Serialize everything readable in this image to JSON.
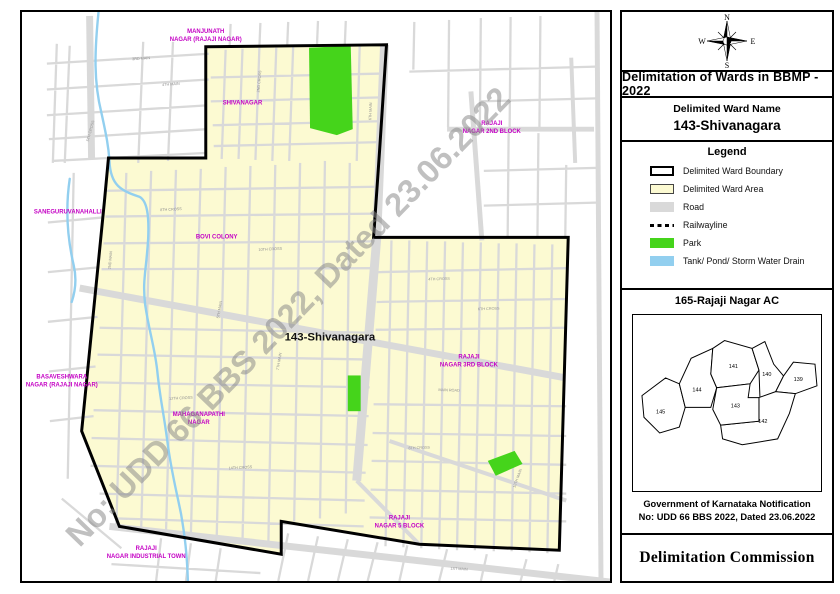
{
  "panel": {
    "compass": {
      "n": "N",
      "e": "E",
      "s": "S",
      "w": "W"
    },
    "title": "Delimitation of Wards in BBMP - 2022",
    "ward_name_heading": "Delimited Ward Name",
    "ward_name": "143-Shivanagara",
    "legend": {
      "heading": "Legend",
      "items": [
        {
          "label": "Delimited Ward Boundary",
          "swatch": "boundary"
        },
        {
          "label": "Delimited Ward Area",
          "swatch": "area",
          "color": "#fcfad2"
        },
        {
          "label": "Road",
          "swatch": "road",
          "color": "#d9d9d9"
        },
        {
          "label": "Railwayline",
          "swatch": "railway"
        },
        {
          "label": "Park",
          "swatch": "park",
          "color": "#45d41b"
        },
        {
          "label": "Tank/ Pond/ Storm Water Drain",
          "swatch": "tank",
          "color": "#92cfef"
        }
      ]
    },
    "ac_title": "165-Rajaji Nagar AC",
    "inset_wards": [
      {
        "id": "145",
        "x": 27,
        "y": 100,
        "highlight": false
      },
      {
        "id": "144",
        "x": 64,
        "y": 78,
        "highlight": false
      },
      {
        "id": "141",
        "x": 101,
        "y": 54,
        "highlight": false
      },
      {
        "id": "140",
        "x": 135,
        "y": 62,
        "highlight": false
      },
      {
        "id": "139",
        "x": 167,
        "y": 67,
        "highlight": false
      },
      {
        "id": "143",
        "x": 103,
        "y": 94,
        "highlight": true
      },
      {
        "id": "142",
        "x": 131,
        "y": 110,
        "highlight": false
      }
    ],
    "notification_line1": "Government of Karnataka Notification",
    "notification_line2": "No: UDD 66 BBS 2022, Dated 23.06.2022",
    "commission": "Delimitation Commission"
  },
  "map": {
    "watermark": "No: UDD 66 BBS 2022, Dated 23.06.2022",
    "colors": {
      "ward_area": "#fcfad2",
      "inset_highlight": "#f7f3bd",
      "road": "#d9d9d9",
      "park": "#45d41b",
      "water": "#92cfef",
      "boundary": "#000000",
      "area_label": "#c400c4",
      "watermark": "#888888"
    },
    "area_labels": [
      {
        "text": "MANJUNATH",
        "x": 185,
        "y": 21
      },
      {
        "text": "NAGAR (RAJAJI NAGAR)",
        "x": 185,
        "y": 29
      },
      {
        "text": "SHIVANAGAR",
        "x": 222,
        "y": 93
      },
      {
        "text": "RAJAJI",
        "x": 473,
        "y": 114
      },
      {
        "text": "NAGAR 2ND BLOCK",
        "x": 473,
        "y": 122
      },
      {
        "text": "SANEGURUVANAHALLI",
        "x": 46,
        "y": 203
      },
      {
        "text": "BOVI COLONY",
        "x": 196,
        "y": 228
      },
      {
        "text": "143-Shivanagara",
        "x": 310,
        "y": 331,
        "color": "#111111",
        "size": 11.5
      },
      {
        "text": "RAJAJI",
        "x": 450,
        "y": 349
      },
      {
        "text": "NAGAR 3RD BLOCK",
        "x": 450,
        "y": 357
      },
      {
        "text": "BASAVESHWARA",
        "x": 40,
        "y": 369
      },
      {
        "text": "NAGAR (RAJAJI NAGAR)",
        "x": 40,
        "y": 377
      },
      {
        "text": "MAHAGANAPATHI",
        "x": 178,
        "y": 407
      },
      {
        "text": "NAGAR",
        "x": 178,
        "y": 415
      },
      {
        "text": "RAJAJI",
        "x": 380,
        "y": 511
      },
      {
        "text": "NAGAR 5 BLOCK",
        "x": 380,
        "y": 519
      },
      {
        "text": "RAJAJI",
        "x": 125,
        "y": 542
      },
      {
        "text": "NAGAR INDUSTRIAL TOWN",
        "x": 125,
        "y": 550
      }
    ],
    "street_labels": [
      {
        "t": "3RD MAIN",
        "x": 120,
        "y": 48,
        "r": -4
      },
      {
        "t": "4TH MAIN",
        "x": 150,
        "y": 74,
        "r": -4
      },
      {
        "t": "5TH CROSS",
        "x": 70,
        "y": 120,
        "r": -75
      },
      {
        "t": "2ND CROSS",
        "x": 240,
        "y": 70,
        "r": -85
      },
      {
        "t": "6TH MAIN",
        "x": 352,
        "y": 100,
        "r": -88
      },
      {
        "t": "8TH CROSS",
        "x": 150,
        "y": 200,
        "r": -3
      },
      {
        "t": "10TH CROSS",
        "x": 250,
        "y": 240,
        "r": -3
      },
      {
        "t": "5TH MAIN",
        "x": 200,
        "y": 300,
        "r": -80
      },
      {
        "t": "7TH MAIN",
        "x": 260,
        "y": 352,
        "r": -80
      },
      {
        "t": "12TH CROSS",
        "x": 160,
        "y": 390,
        "r": -3
      },
      {
        "t": "14TH CROSS",
        "x": 220,
        "y": 460,
        "r": -3
      },
      {
        "t": "2ND MAIN",
        "x": 90,
        "y": 250,
        "r": -85
      },
      {
        "t": "4TH CROSS",
        "x": 420,
        "y": 270,
        "r": -2
      },
      {
        "t": "6TH CROSS",
        "x": 470,
        "y": 300,
        "r": -2
      },
      {
        "t": "MAIN ROAD",
        "x": 430,
        "y": 382,
        "r": 2
      },
      {
        "t": "8TH CROSS",
        "x": 400,
        "y": 440,
        "r": -2
      },
      {
        "t": "10TH MAIN",
        "x": 500,
        "y": 470,
        "r": -70
      },
      {
        "t": "1ST MAIN",
        "x": 440,
        "y": 562,
        "r": 3
      }
    ]
  }
}
